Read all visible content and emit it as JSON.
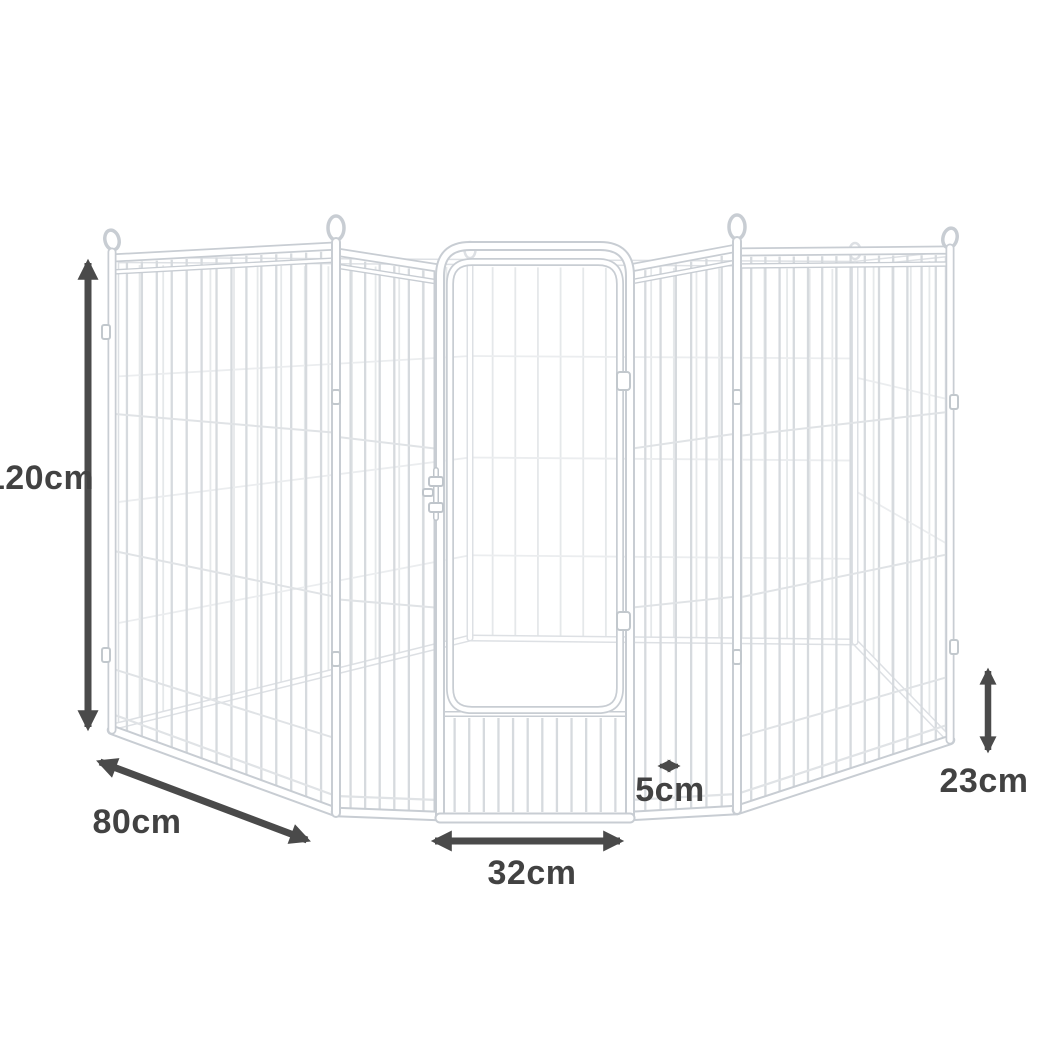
{
  "figure": {
    "type": "product-dimension-diagram",
    "subject": "metal pet playpen with gate",
    "background": "#ffffff"
  },
  "dimensions": [
    {
      "id": "height",
      "label": "120cm",
      "icon": "double-arrow-vertical-icon",
      "position": "left"
    },
    {
      "id": "panel-width",
      "label": "80cm",
      "icon": "double-arrow-diagonal-icon",
      "position": "bottom-left"
    },
    {
      "id": "door-width",
      "label": "32cm",
      "icon": "double-arrow-horizontal-icon",
      "position": "bottom-center"
    },
    {
      "id": "bar-gap",
      "label": "5cm",
      "icon": "double-arrow-horizontal-icon",
      "position": "center-right"
    },
    {
      "id": "bottom-height",
      "label": "23cm",
      "icon": "double-arrow-vertical-icon",
      "position": "bottom-right"
    }
  ],
  "colors": {
    "annotation": "#4a4a4a",
    "annotation_text": "#424242",
    "frame_outline": "#c8cdd3",
    "product_fill": "#ffffff"
  }
}
